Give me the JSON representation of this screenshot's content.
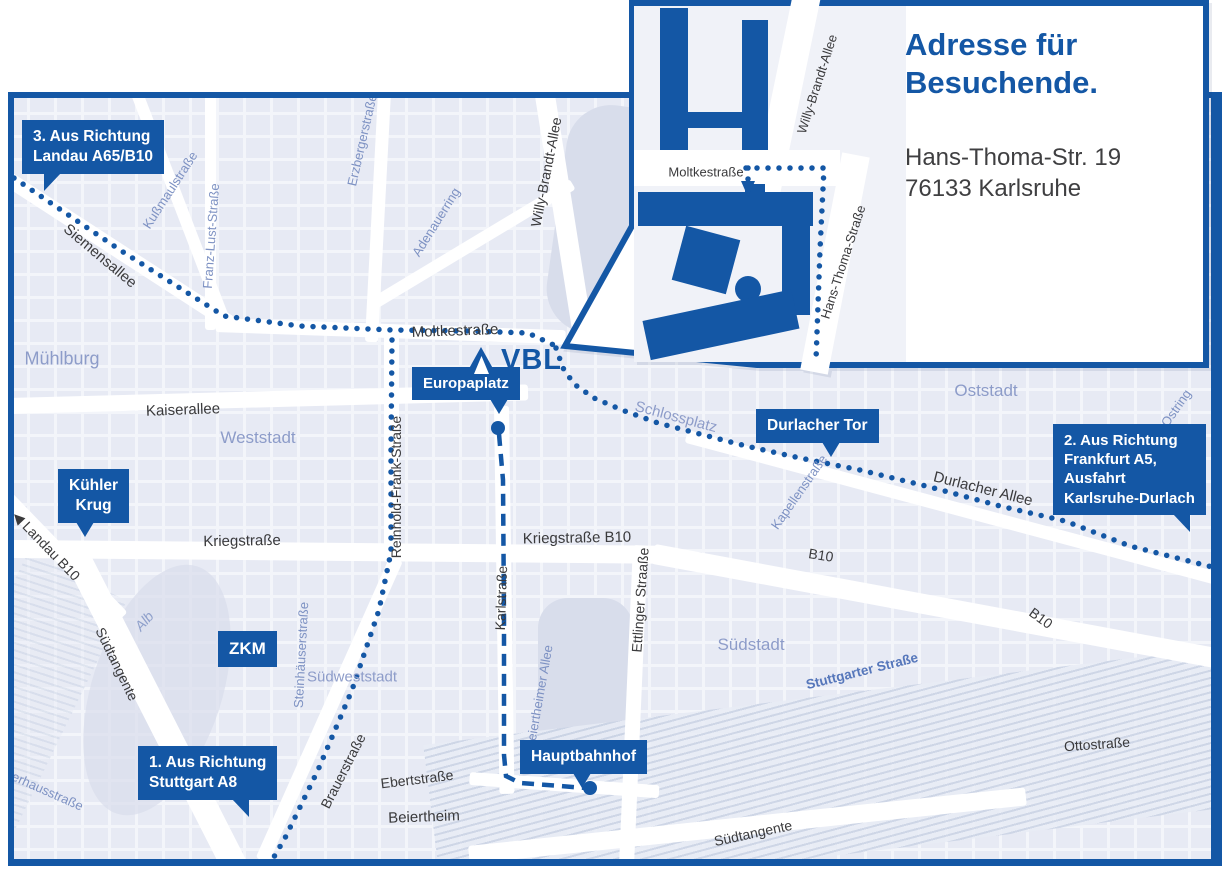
{
  "colors": {
    "primary": "#1457a5",
    "map_bg": "#f3f5fa",
    "block": "#e3e7f2",
    "park": "#d8ddeb",
    "road": "#ffffff",
    "rail_hatch": "#c9d2e4",
    "label_dark": "#3a3a3c",
    "label_blue": "#7e92c3",
    "label_district": "#8d9cc9"
  },
  "logo": {
    "text": "VBL"
  },
  "inset": {
    "title_line1": "Adresse für",
    "title_line2": "Besuchende.",
    "address_line1": "Hans-Thoma-Str. 19",
    "address_line2": "76133 Karlsruhe",
    "labels": [
      {
        "id": "inset-moltkestrasse",
        "text": "Moltkestraße",
        "x": 146,
        "y": 172,
        "rot": 0,
        "cls": "dark",
        "size": 13
      },
      {
        "id": "inset-willy-brandt-allee",
        "text": "Willy-Brandt-Allee",
        "x": 257,
        "y": 84,
        "rot": -72,
        "cls": "dark",
        "size": 13
      },
      {
        "id": "inset-hans-thoma-strasse",
        "text": "Hans-Thoma-Straße",
        "x": 283,
        "y": 262,
        "rot": -72,
        "cls": "dark",
        "size": 13
      }
    ]
  },
  "badges": [
    {
      "id": "richtung-landau",
      "x": 22,
      "y": 120,
      "size": 15.5,
      "align": "left",
      "lines": [
        "3. Aus Richtung",
        "Landau A65/B10"
      ],
      "tail": {
        "style": "cutL",
        "left": "22px"
      }
    },
    {
      "id": "richtung-frankfurt",
      "x": 1053,
      "y": 424,
      "size": 15,
      "align": "left",
      "lines": [
        "2. Aus Richtung",
        "Frankfurt A5,",
        "Ausfahrt",
        "Karlsruhe-Durlach"
      ],
      "tail": {
        "style": "cutR",
        "right": "16px"
      }
    },
    {
      "id": "richtung-stuttgart",
      "x": 138,
      "y": 746,
      "size": 15.5,
      "align": "left",
      "lines": [
        "1. Aus Richtung",
        "Stuttgart A8"
      ],
      "tail": {
        "style": "cutR",
        "right": "28px"
      }
    },
    {
      "id": "europaplatz",
      "x": 412,
      "y": 367,
      "size": 15,
      "align": "center",
      "lines": [
        "Europaplatz"
      ],
      "tail": {
        "style": "iso",
        "left": "72%"
      }
    },
    {
      "id": "durlacher-tor",
      "x": 756,
      "y": 409,
      "size": 15.5,
      "align": "center",
      "lines": [
        "Durlacher Tor"
      ],
      "tail": {
        "style": "iso",
        "left": "54%"
      }
    },
    {
      "id": "kuehler-krug",
      "x": 58,
      "y": 469,
      "size": 15.5,
      "align": "center",
      "lines": [
        "Kühler",
        "Krug"
      ],
      "tail": {
        "style": "iso",
        "left": "26%"
      }
    },
    {
      "id": "zkm",
      "x": 218,
      "y": 631,
      "size": 17,
      "align": "center",
      "lines": [
        "ZKM"
      ],
      "tail": null
    },
    {
      "id": "hauptbahnhof",
      "x": 520,
      "y": 740,
      "size": 15.5,
      "align": "center",
      "lines": [
        "Hauptbahnhof"
      ],
      "tail": {
        "style": "iso",
        "left": "42%"
      }
    }
  ],
  "labels": [
    {
      "id": "siemensallee",
      "text": "Siemensallee",
      "x": 100,
      "y": 256,
      "rot": 40,
      "cls": "dark",
      "size": 15
    },
    {
      "id": "moltkestrasse",
      "text": "Moltkestraße",
      "x": 455,
      "y": 331,
      "rot": -2,
      "cls": "dark",
      "size": 15
    },
    {
      "id": "kaiserallee",
      "text": "Kaiserallee",
      "x": 183,
      "y": 410,
      "rot": -2,
      "cls": "dark",
      "size": 15
    },
    {
      "id": "kriegstrasse",
      "text": "Kriegstraße",
      "x": 242,
      "y": 541,
      "rot": -1,
      "cls": "dark",
      "size": 15
    },
    {
      "id": "kriegstrasse-b10",
      "text": "Kriegstraße B10",
      "x": 577,
      "y": 538,
      "rot": -1,
      "cls": "dark",
      "size": 15
    },
    {
      "id": "durlacher-allee",
      "text": "Durlacher Allee",
      "x": 983,
      "y": 489,
      "rot": 14,
      "cls": "dark",
      "size": 15
    },
    {
      "id": "b10-sued",
      "text": "B10",
      "x": 821,
      "y": 555,
      "rot": 9,
      "cls": "dark",
      "size": 14
    },
    {
      "id": "b10-ost",
      "text": "B10",
      "x": 1041,
      "y": 618,
      "rot": 36,
      "cls": "dark",
      "size": 14
    },
    {
      "id": "willy-brandt-allee",
      "text": "Willy-Brandt-Allee",
      "x": 546,
      "y": 172,
      "rot": -79,
      "cls": "dark",
      "size": 14
    },
    {
      "id": "reinhold-frank",
      "text": "Reinhold-Frank-Straße",
      "x": 396,
      "y": 487,
      "rot": -90,
      "cls": "dark",
      "size": 14
    },
    {
      "id": "karlstrasse",
      "text": "Karlstraße",
      "x": 501,
      "y": 598,
      "rot": -88,
      "cls": "dark",
      "size": 14
    },
    {
      "id": "ettlinger-strasse",
      "text": "Ettlinger Straaße",
      "x": 640,
      "y": 600,
      "rot": -86,
      "cls": "dark",
      "size": 14
    },
    {
      "id": "brauerstrasse",
      "text": "Brauerstraße",
      "x": 343,
      "y": 771,
      "rot": -63,
      "cls": "dark",
      "size": 14
    },
    {
      "id": "ebertstrasse",
      "text": "Ebertstraße",
      "x": 417,
      "y": 779,
      "rot": -7,
      "cls": "dark",
      "size": 14
    },
    {
      "id": "beiertheim",
      "text": "Beiertheim",
      "x": 424,
      "y": 817,
      "rot": -2,
      "cls": "dark",
      "size": 15
    },
    {
      "id": "suedtangente-west",
      "text": "Südtangente",
      "x": 117,
      "y": 664,
      "rot": 64,
      "cls": "dark",
      "size": 14
    },
    {
      "id": "suedtangente-sued",
      "text": "Südtangente",
      "x": 753,
      "y": 833,
      "rot": -12,
      "cls": "dark",
      "size": 14
    },
    {
      "id": "landau-b10",
      "text": "◀ Landau B10",
      "x": 46,
      "y": 546,
      "rot": 46,
      "cls": "dark",
      "size": 14
    },
    {
      "id": "ottostrasse",
      "text": "Ottostraße",
      "x": 1097,
      "y": 744,
      "rot": -4,
      "cls": "dark",
      "size": 14
    },
    {
      "id": "kussmaulstrasse",
      "text": "Kußmaulstraße",
      "x": 170,
      "y": 190,
      "rot": -57,
      "cls": "blue",
      "size": 13
    },
    {
      "id": "franz-lust-strasse",
      "text": "Franz-Lust-Straße",
      "x": 211,
      "y": 236,
      "rot": -86,
      "cls": "blue",
      "size": 13
    },
    {
      "id": "erzbergerstrasse",
      "text": "Erzbergerstraße",
      "x": 362,
      "y": 140,
      "rot": -77,
      "cls": "blue",
      "size": 13
    },
    {
      "id": "adenauerring",
      "text": "Adenauerring",
      "x": 436,
      "y": 222,
      "rot": -58,
      "cls": "blue",
      "size": 13
    },
    {
      "id": "kapellenstrasse",
      "text": "Kapellenstraße",
      "x": 799,
      "y": 492,
      "rot": -55,
      "cls": "blue",
      "size": 13
    },
    {
      "id": "steinhaeuserstrasse",
      "text": "Steinhäuserstraße",
      "x": 301,
      "y": 655,
      "rot": -87,
      "cls": "blue",
      "size": 13
    },
    {
      "id": "beiertheimer-allee",
      "text": "Beiertheimer Allee",
      "x": 539,
      "y": 697,
      "rot": -80,
      "cls": "blue",
      "size": 13
    },
    {
      "id": "ostring",
      "text": "Ostring",
      "x": 1176,
      "y": 408,
      "rot": -55,
      "cls": "blue",
      "size": 13
    },
    {
      "id": "pulverhausstrasse",
      "text": "Pulverhausstraße",
      "x": 36,
      "y": 786,
      "rot": 24,
      "cls": "blue",
      "size": 13
    },
    {
      "id": "stuttgarter-strasse",
      "text": "Stuttgarter Straße",
      "x": 862,
      "y": 671,
      "rot": -14,
      "cls": "blue-strong",
      "size": 13.5
    },
    {
      "id": "alb",
      "text": "Alb",
      "x": 144,
      "y": 621,
      "rot": -48,
      "cls": "italic",
      "size": 14
    },
    {
      "id": "muehlburg",
      "text": "Mühlburg",
      "x": 62,
      "y": 359,
      "rot": 0,
      "cls": "district",
      "size": 18
    },
    {
      "id": "weststadt",
      "text": "Weststadt",
      "x": 258,
      "y": 438,
      "rot": 0,
      "cls": "district",
      "size": 17
    },
    {
      "id": "oststadt",
      "text": "Oststadt",
      "x": 986,
      "y": 391,
      "rot": 0,
      "cls": "district",
      "size": 17
    },
    {
      "id": "suedstadt",
      "text": "Südstadt",
      "x": 751,
      "y": 645,
      "rot": 0,
      "cls": "district",
      "size": 17
    },
    {
      "id": "suedweststadt",
      "text": "Südweststadt",
      "x": 352,
      "y": 677,
      "rot": 0,
      "cls": "district",
      "size": 15
    },
    {
      "id": "schlossplatz",
      "text": "Schlossplatz",
      "x": 676,
      "y": 417,
      "rot": 15,
      "cls": "district",
      "size": 15
    }
  ],
  "routes": [
    {
      "id": "route-von-landau",
      "style": "dotted",
      "container": "main",
      "points": "14,178 120,250 224,316 300,326 392,330 470,331 528,333 556,346"
    },
    {
      "id": "route-von-stuttgart",
      "style": "dotted",
      "container": "main",
      "points": "392,340 391,450 391,552 379,610 352,690 318,770 285,838 264,874"
    },
    {
      "id": "route-von-frankfurt",
      "style": "dotted",
      "container": "main",
      "points": "556,348 563,368 574,384 594,398 622,410 658,423 700,434 746,446 800,458 860,470 930,487 1000,506 1065,521 1130,546 1228,571"
    },
    {
      "id": "route-hauptbahnhof-tram",
      "style": "dashed",
      "container": "main",
      "points": "499,434 503,480 504,620 504,755 506,776 520,783 560,786 586,788"
    },
    {
      "id": "route-inset-zufahrt",
      "style": "dotted",
      "container": "inset",
      "points": "186,168 264,168 260,250 256,360"
    },
    {
      "id": "route-inset-eingang",
      "style": "dotted",
      "container": "inset",
      "points": "188,168 188,180"
    }
  ],
  "stops": [
    {
      "id": "europaplatz-stop",
      "x": 498,
      "y": 428,
      "r": 7
    },
    {
      "id": "hauptbahnhof-stop",
      "x": 590,
      "y": 788,
      "r": 7
    }
  ]
}
